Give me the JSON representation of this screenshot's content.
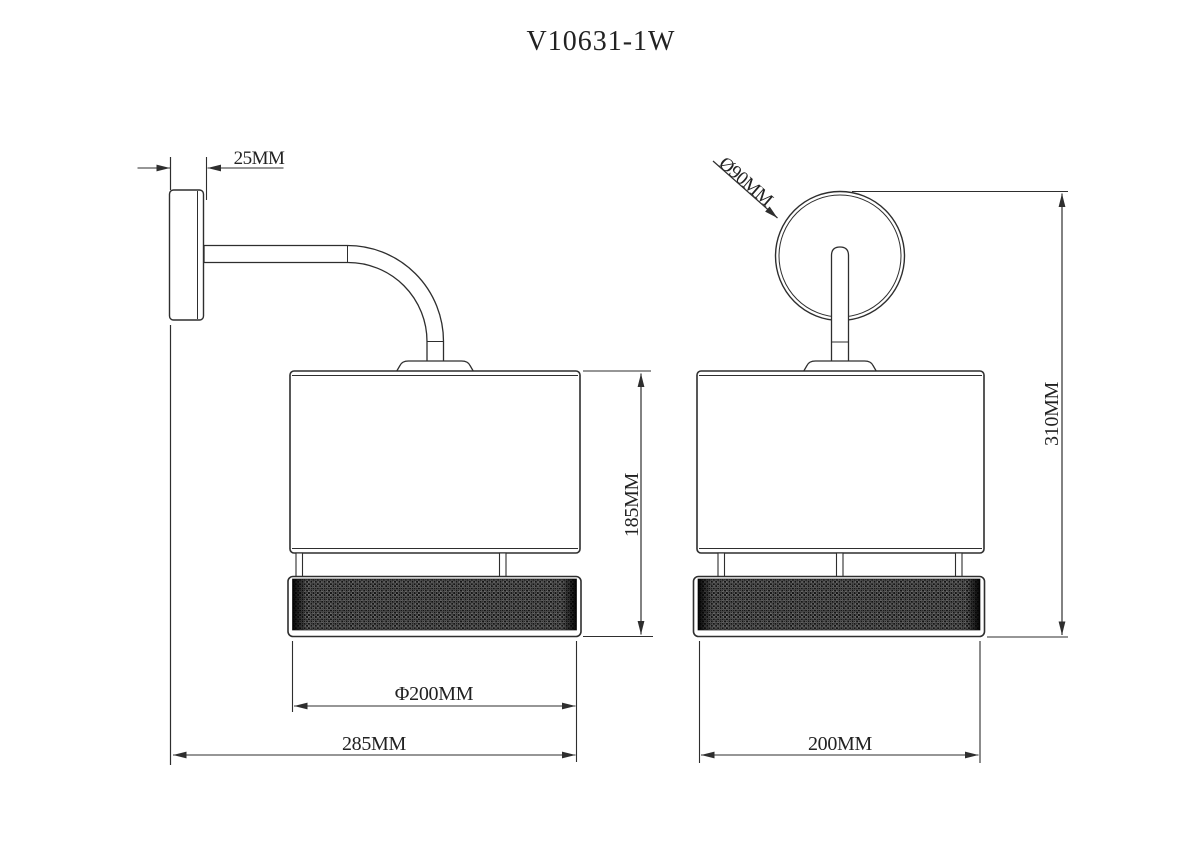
{
  "drawing": {
    "title": "V10631-1W",
    "type_note": "wall lamp technical drawing, two orthographic views",
    "side_view": {
      "label": "side-view",
      "dims": {
        "plate_depth": "25MM",
        "shade_height": "185MM",
        "shade_diameter": "Φ200MM",
        "total_depth": "285MM"
      }
    },
    "front_view": {
      "label": "front-view",
      "dims": {
        "backplate_diameter": "Ø90MM",
        "total_height": "310MM",
        "shade_width": "200MM"
      }
    },
    "colors": {
      "line": "#2e2e2e",
      "background": "#ffffff",
      "mesh_dark": "#141414",
      "mesh_dot": "#969696"
    }
  }
}
